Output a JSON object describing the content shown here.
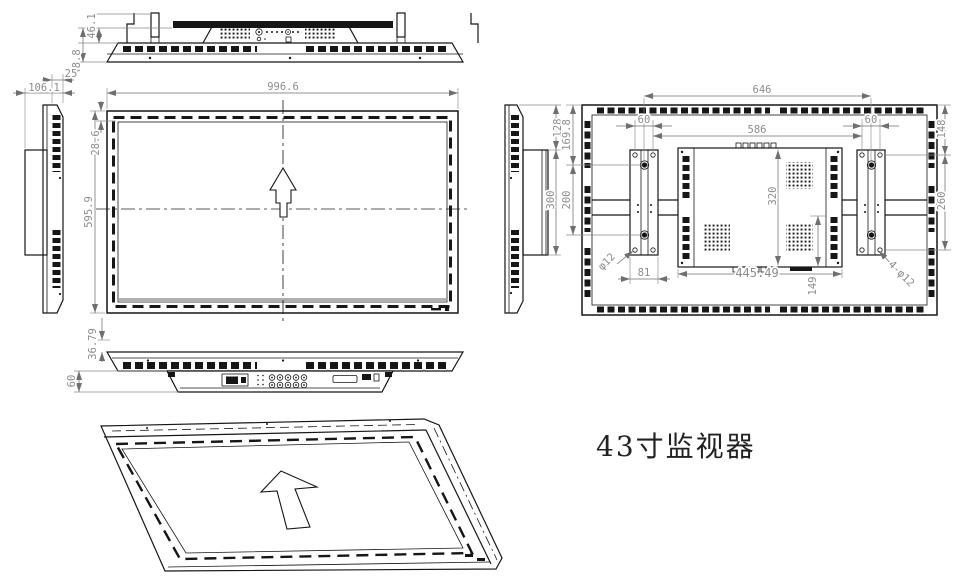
{
  "title": "43寸监视器",
  "colors": {
    "line": "#161616",
    "dim_line": "#6f6f6f",
    "dim_text": "#8d8d8d",
    "screen_strip": "#b0b0b0"
  },
  "dims": {
    "top_bracket_height": "46.1",
    "top_total_height": "48.8",
    "side_body_depth": "25",
    "side_total_depth": "106.1",
    "front_width": "996.6",
    "front_top_bezel": "28.6",
    "front_height": "595.9",
    "bottom_bezel": "36.79",
    "bottom_panel_depth": "60",
    "mount_top_offset": "128",
    "mount_length": "300",
    "rear_bracket_span": "646",
    "rear_inner_span": "586",
    "rear_left_hole_spacing": "60",
    "rear_right_hole_spacing": "60",
    "rear_left_top_offset": "169.8",
    "rear_left_hole_pitch": "200",
    "rear_right_top_offset": "148",
    "rear_right_hole_pitch": "260",
    "rear_box_height": "320",
    "rear_box_width": "445.49",
    "rear_box_bottom_offset": "149",
    "rear_bracket_width": "81",
    "rear_hole_note_left": "φ12",
    "rear_hole_note_right": "4-φ12"
  }
}
